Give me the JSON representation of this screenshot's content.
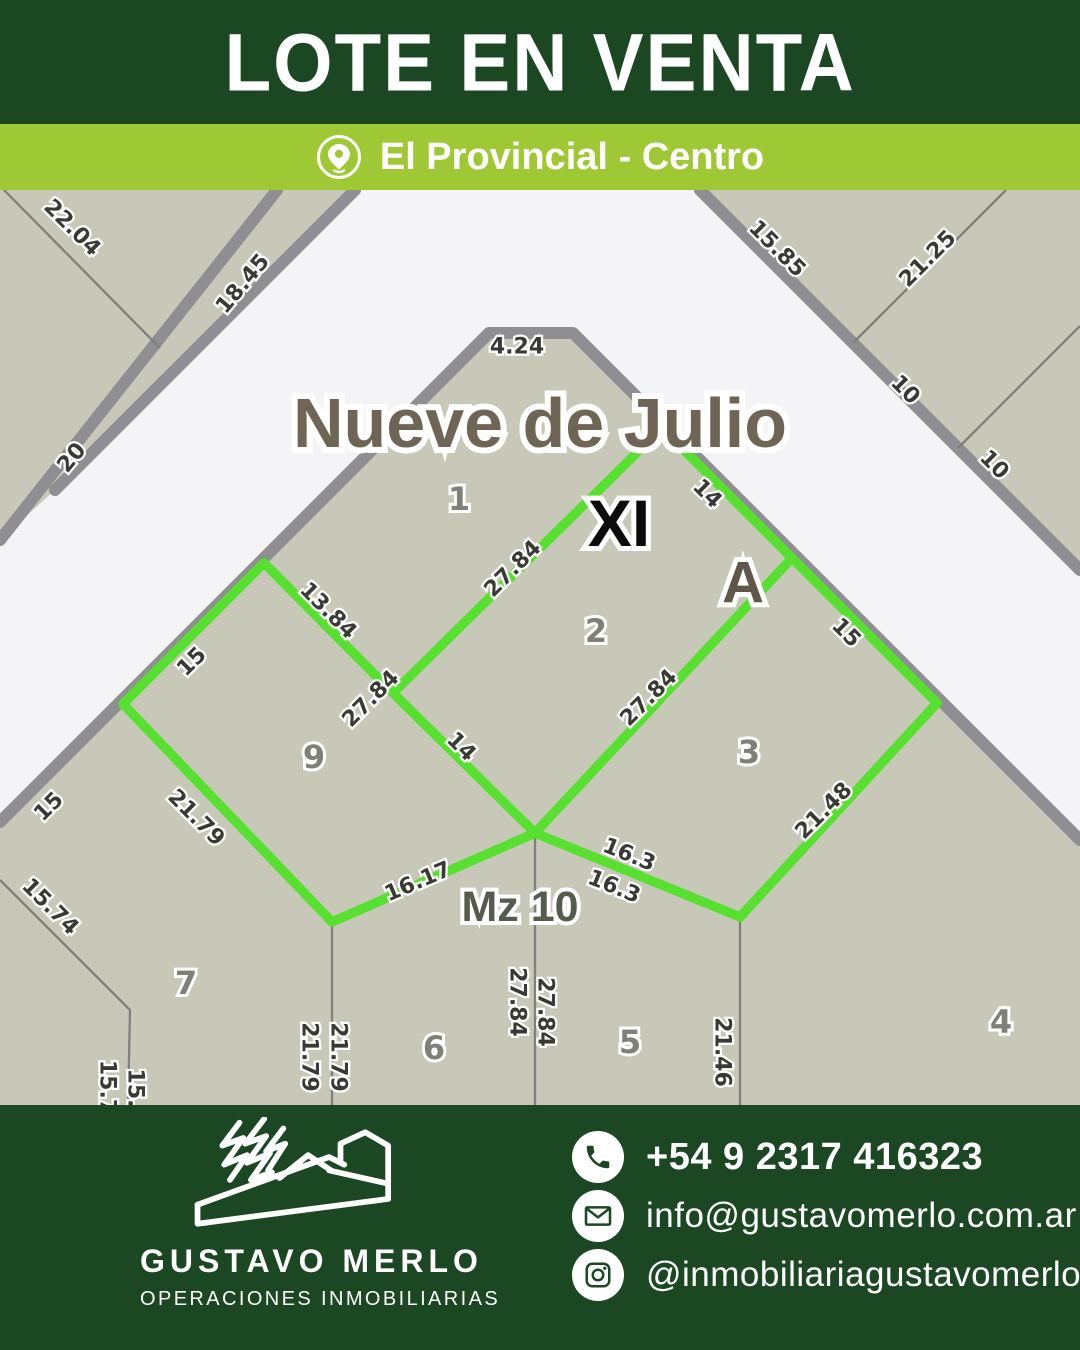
{
  "theme": {
    "dark_green": "#1b4723",
    "light_green": "#9ec935",
    "white": "#ffffff"
  },
  "header": {
    "title": "LOTE EN VENTA"
  },
  "location_bar": {
    "icon": "location-pin-icon",
    "label": "El Provincial - Centro"
  },
  "map": {
    "street_name": "Nueve de Julio",
    "zone_label": "XI",
    "lot_letter": "A",
    "block_label": "Mz 10",
    "colors": {
      "street_bg": "#f4f4f6",
      "block_fill": "#c8c8b8",
      "street_border": "#8e8e93",
      "lot_line": "#80807a",
      "highlight": "#58e030"
    },
    "big_labels": [
      {
        "t": "Nueve de Julio",
        "x": 540,
        "y": 233,
        "cls": "street-name",
        "name": "street-name-label"
      },
      {
        "t": "XI",
        "x": 619,
        "y": 333,
        "cls": "zone-label",
        "name": "zone-roman-label"
      },
      {
        "t": "A",
        "x": 743,
        "y": 393,
        "cls": "lot-letter",
        "name": "highlighted-lot-letter"
      },
      {
        "t": "Mz 10",
        "x": 520,
        "y": 717,
        "cls": "block-label",
        "name": "block-number-label"
      }
    ],
    "lot_numbers": [
      {
        "t": "1",
        "x": 459,
        "y": 309
      },
      {
        "t": "2",
        "x": 596,
        "y": 441
      },
      {
        "t": "3",
        "x": 749,
        "y": 562
      },
      {
        "t": "4",
        "x": 1001,
        "y": 832
      },
      {
        "t": "5",
        "x": 630,
        "y": 852
      },
      {
        "t": "6",
        "x": 434,
        "y": 858
      },
      {
        "t": "7",
        "x": 186,
        "y": 793
      },
      {
        "t": "9",
        "x": 314,
        "y": 567
      }
    ],
    "measurements": [
      {
        "t": "22.04",
        "x": 72,
        "y": 38,
        "r": 45
      },
      {
        "t": "18.45",
        "x": 243,
        "y": 94,
        "r": -50
      },
      {
        "t": "20",
        "x": 72,
        "y": 268,
        "r": -50
      },
      {
        "t": "15.85",
        "x": 777,
        "y": 59,
        "r": 45
      },
      {
        "t": "21.25",
        "x": 928,
        "y": 69,
        "r": -45
      },
      {
        "t": "10",
        "x": 905,
        "y": 200,
        "r": 45
      },
      {
        "t": "10",
        "x": 994,
        "y": 275,
        "r": 45
      },
      {
        "t": "4.24",
        "x": 517,
        "y": 157,
        "r": 0
      },
      {
        "t": "27.84",
        "x": 513,
        "y": 379,
        "r": -45
      },
      {
        "t": "27.84",
        "x": 371,
        "y": 509,
        "r": -45
      },
      {
        "t": "13.84",
        "x": 328,
        "y": 421,
        "r": 45
      },
      {
        "t": "15",
        "x": 192,
        "y": 472,
        "r": -45
      },
      {
        "t": "14",
        "x": 707,
        "y": 304,
        "r": 45
      },
      {
        "t": "15",
        "x": 846,
        "y": 443,
        "r": 45
      },
      {
        "t": "27.84",
        "x": 649,
        "y": 508,
        "r": -45
      },
      {
        "t": "14",
        "x": 461,
        "y": 557,
        "r": 45
      },
      {
        "t": "21.79",
        "x": 196,
        "y": 628,
        "r": 45
      },
      {
        "t": "21.48",
        "x": 824,
        "y": 621,
        "r": -45
      },
      {
        "t": "16.17",
        "x": 418,
        "y": 692,
        "r": -23
      },
      {
        "t": "16.3",
        "x": 629,
        "y": 665,
        "r": 22
      },
      {
        "t": "16.3",
        "x": 614,
        "y": 697,
        "r": 22
      },
      {
        "t": "15",
        "x": 49,
        "y": 617,
        "r": -45
      },
      {
        "t": "15.74",
        "x": 50,
        "y": 717,
        "r": 45
      },
      {
        "t": "21.79",
        "x": 309,
        "y": 867,
        "r": 90
      },
      {
        "t": "21.79",
        "x": 338,
        "y": 867,
        "r": 90
      },
      {
        "t": "27.84",
        "x": 517,
        "y": 812,
        "r": 90
      },
      {
        "t": "27.84",
        "x": 545,
        "y": 822,
        "r": 90
      },
      {
        "t": "21.46",
        "x": 722,
        "y": 862,
        "r": 90
      },
      {
        "t": "15.7",
        "x": 107,
        "y": 897,
        "r": 90
      },
      {
        "t": "15.",
        "x": 135,
        "y": 898,
        "r": 90
      }
    ],
    "geometry": {
      "blocks": [
        {
          "name": "block-central",
          "points": "0,632 489,143 573,143 1080,650 1080,915 0,915"
        },
        {
          "name": "block-top-left",
          "points": "0,0 277,0 0,350"
        },
        {
          "name": "block-top-left-wedge",
          "points": "277,0 355,0 55,300 0,350"
        },
        {
          "name": "block-top-right",
          "points": "700,0 1080,0 1080,380"
        }
      ],
      "street_borders": [
        "0,632 489,143 573,143 1080,650",
        "277,0 0,350",
        "355,0 55,300",
        "700,0 1080,380"
      ],
      "lot_lines": [
        "4,0 160,158",
        "853,153 1006,0",
        "958,258 1080,136",
        "332,732 332,915",
        "535,643 535,915",
        "740,727 740,915",
        "130,820 128,915",
        "0,690 130,820"
      ],
      "highlight_segments": [
        "264,373 393,503",
        "393,503 662,238",
        "662,238 792,368 937,513",
        "937,513 740,727",
        "740,727 535,643",
        "535,643 332,732",
        "332,732 123,514",
        "123,514 264,373",
        "393,503 535,643",
        "535,643 792,368"
      ]
    }
  },
  "footer": {
    "brand": {
      "name": "GUSTAVO MERLO",
      "tagline": "OPERACIONES INMOBILIARIAS",
      "logo": "building-logo"
    },
    "contacts": [
      {
        "icon": "phone-icon",
        "value": "+54 9 2317 416323"
      },
      {
        "icon": "email-icon",
        "value": "info@gustavomerlo.com.ar"
      },
      {
        "icon": "instagram-icon",
        "value": "@inmobiliariagustavomerlo"
      }
    ]
  }
}
